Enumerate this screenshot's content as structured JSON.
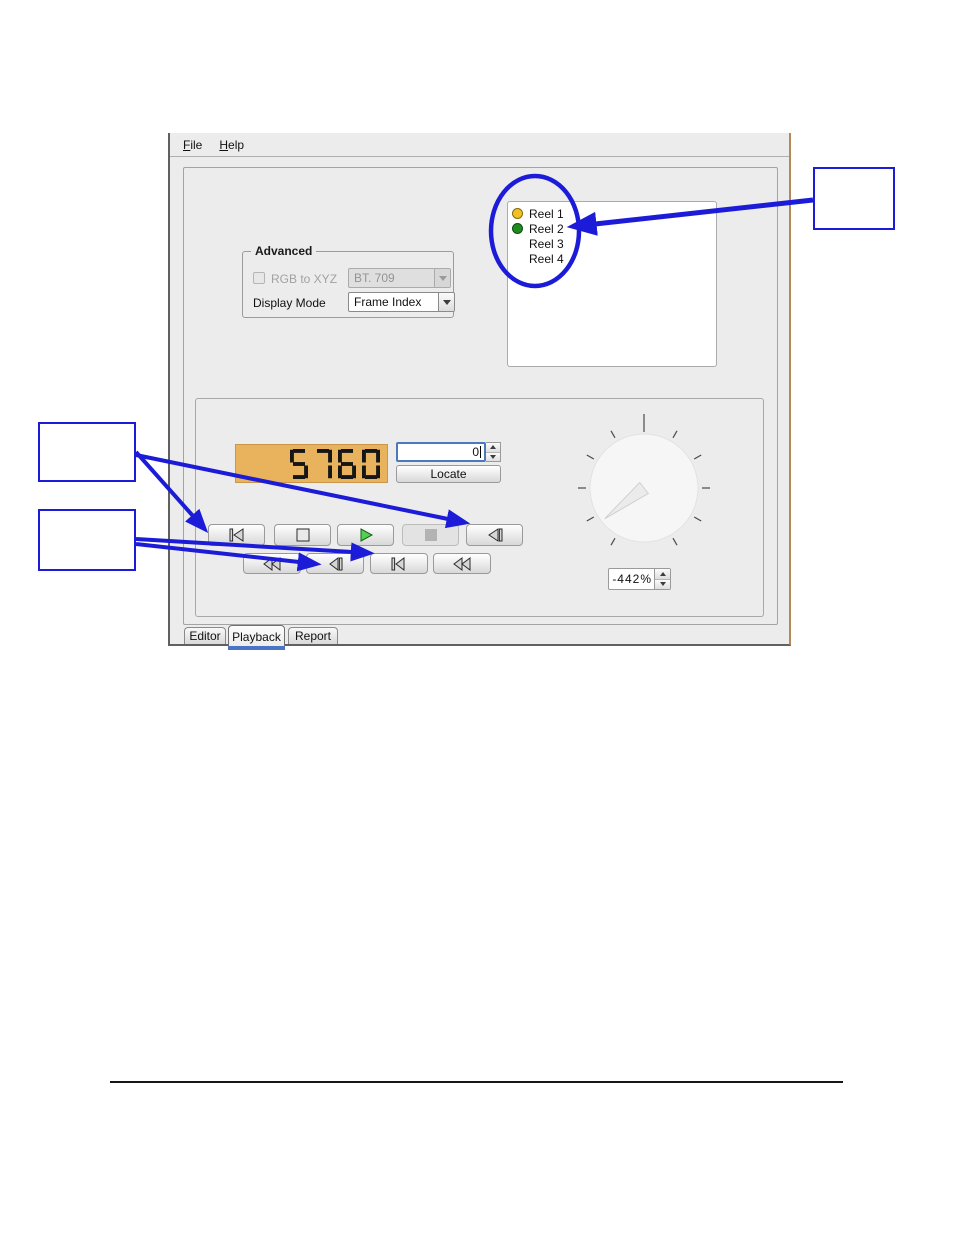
{
  "window": {
    "menu": {
      "items": [
        {
          "label": "File"
        },
        {
          "label": "Help"
        }
      ]
    },
    "advanced": {
      "title": "Advanced",
      "rgb_to_xyz_label": "RGB to XYZ",
      "colorspace_value": "BT. 709",
      "display_mode_label": "Display Mode",
      "display_mode_value": "Frame Index"
    },
    "reel_list": {
      "items": [
        {
          "label": "Reel 1",
          "status": "yellow",
          "color": "#f3c11d"
        },
        {
          "label": "Reel 2",
          "status": "green",
          "color": "#1f8a1f"
        },
        {
          "label": "Reel 3",
          "status": "none",
          "color": ""
        },
        {
          "label": "Reel 4",
          "status": "none",
          "color": ""
        }
      ]
    },
    "playback": {
      "lcd_value": "5760",
      "frame_field_value": "0",
      "locate_label": "Locate",
      "speed_value": "-442%",
      "transport_row1": [
        "skip-to-start",
        "stop",
        "play",
        "stop-disabled",
        "skip-to-end"
      ],
      "transport_row2": [
        "rewind",
        "step-back",
        "step-forward",
        "fast-forward"
      ]
    },
    "tabs": [
      {
        "label": "Editor"
      },
      {
        "label": "Playback"
      },
      {
        "label": "Report"
      }
    ],
    "selected_tab": "Playback"
  },
  "colors": {
    "annotation_blue": "#1c1cd8",
    "lcd_background": "#e9b25d",
    "play_green": "#4fd24f",
    "reel_yellow": "#f3c11d",
    "reel_green": "#1f8a1f",
    "window_border_tan": "#b5885c",
    "tab_highlight_blue": "#4a74c4"
  }
}
